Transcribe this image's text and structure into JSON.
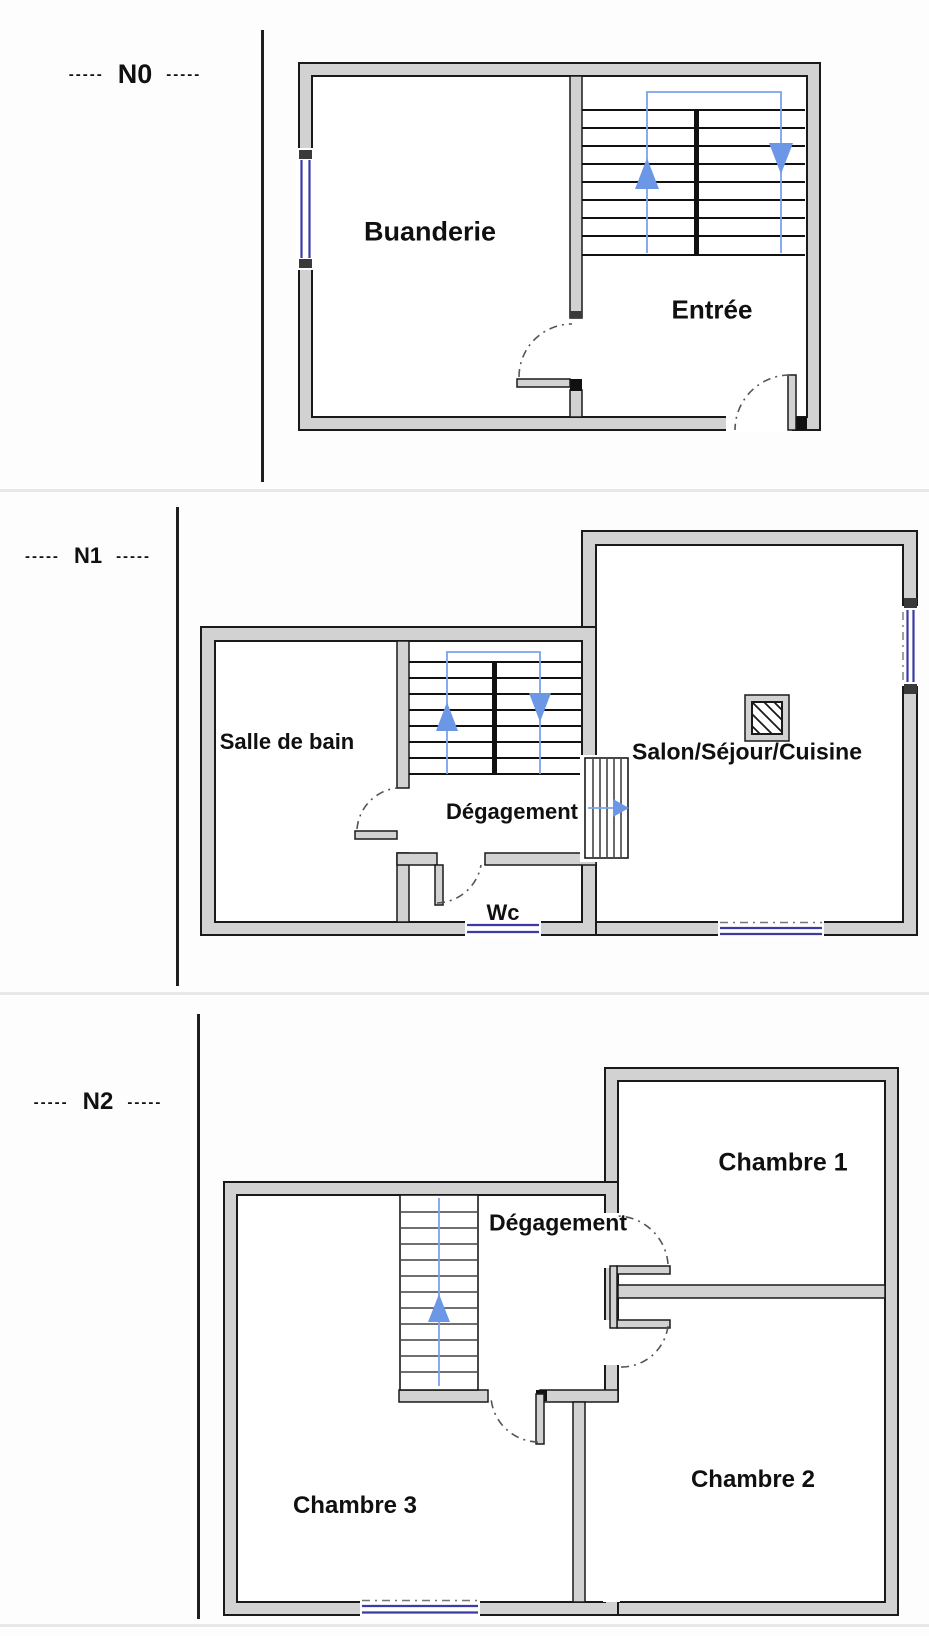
{
  "colors": {
    "wall_fill": "#d2d2d2",
    "outline": "#1a1a1a",
    "stair_guide_blue": "#7aa3ec",
    "arrow_blue": "#6c96e6",
    "window_blue": "#3b3ba8",
    "section_divider": "#e8e8e8"
  },
  "floors": [
    {
      "id": "n0",
      "dash_left": "-----",
      "label": "N0",
      "dash_right": "-----",
      "rooms": [
        {
          "name": "Buanderie"
        },
        {
          "name": "Entrée"
        }
      ]
    },
    {
      "id": "n1",
      "dash_left": "-----",
      "label": "N1",
      "dash_right": "-----",
      "rooms": [
        {
          "name": "Salle de bain"
        },
        {
          "name": "Dégagement"
        },
        {
          "name": "Wc"
        },
        {
          "name": "Salon/Séjour/Cuisine"
        }
      ]
    },
    {
      "id": "n2",
      "dash_left": "-----",
      "label": "N2",
      "dash_right": "-----",
      "rooms": [
        {
          "name": "Chambre 1"
        },
        {
          "name": "Dégagement"
        },
        {
          "name": "Chambre 3"
        },
        {
          "name": "Chambre 2"
        }
      ]
    }
  ]
}
